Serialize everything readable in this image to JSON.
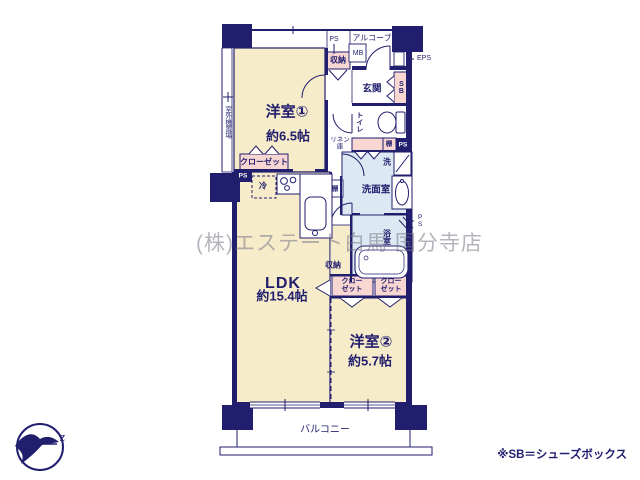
{
  "colors": {
    "wall": "#211e6e",
    "room_fill": "#f7ecca",
    "closet_fill": "#f8d7d2",
    "wet_fill": "#dde9f2",
    "text": "#211e6e",
    "watermark_text": "rgba(118,118,135,0.55)"
  },
  "rooms": {
    "room1": {
      "name": "洋室①",
      "size": "約6.5帖"
    },
    "ldk": {
      "name": "LDK",
      "size": "約15.4帖"
    },
    "room2": {
      "name": "洋室②",
      "size": "約5.7帖"
    },
    "balcony": {
      "name": "バルコニー"
    },
    "entrance": {
      "name": "玄関"
    },
    "alcove": {
      "name": "アルコーブ"
    },
    "toilet": {
      "name": "トイレ"
    },
    "washroom": {
      "name": "洗面室"
    },
    "bathroom": {
      "name": "浴室"
    },
    "outdoor_unit": {
      "name": "室外機置場"
    }
  },
  "fixtures": {
    "storage_hall": "収納",
    "storage_ldk": "収納",
    "closet_room1": "クローゼット",
    "closet2a_line1": "クロー",
    "closet2a_line2": "ゼット",
    "closet2b_line1": "クロー",
    "closet2b_line2": "ゼット",
    "linen_line1": "リネン",
    "linen_line2": "庫",
    "shelf_hall": "棚",
    "shelf_kitchen": "棚",
    "fridge": "冷",
    "laundry": "洗",
    "shoe_box": "SB",
    "meter_box": "MB",
    "ps_top": "PS",
    "ps_left": "PS",
    "ps_mid": "PS",
    "ps_right": "PS",
    "eps": "EPS"
  },
  "annotations": {
    "watermark": "(株)エステート白馬 国分寺店",
    "note": "※SB＝シューズボックス",
    "compass_letter": "z"
  }
}
